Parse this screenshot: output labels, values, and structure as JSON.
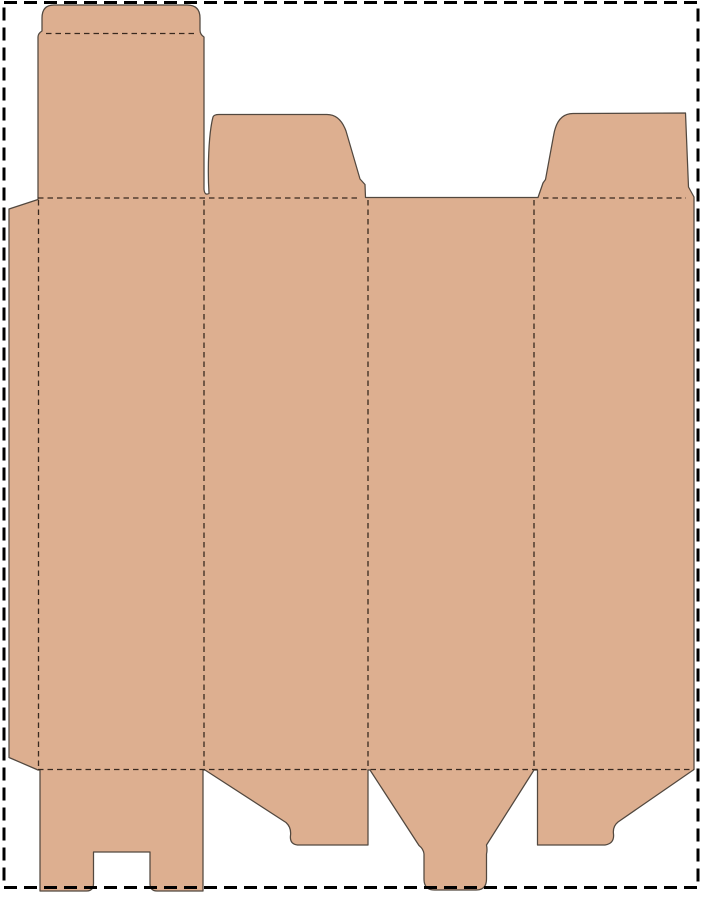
{
  "diagram": {
    "type": "packaging-dieline",
    "description": "Die-cut folding carton template (dieline): four body panels with glue flap, tuck-top lid, two top dust flaps, and bottom closure flaps, inside a dashed cutting-mat border",
    "canvas": {
      "width": 701,
      "height": 900
    },
    "colors": {
      "background": "#ffffff",
      "board_fill": "#DDAF90",
      "cut_line": "#52483f",
      "fold_line": "#39291f",
      "sheet_border": "#000000"
    },
    "sheet_border": {
      "x": 4,
      "y": 2.5,
      "width": 694,
      "height": 885,
      "stroke_width": 3,
      "dash": "13 7"
    },
    "blank": {
      "outline_path": "M 54 5 L 187 5 Q 200 5 200 18 L 200 30 Q 200 34.5 204 37 L 204 189 Q 204.5 196 209 193.5 C 207.5 170 208.5 134 213 117 Q 214 114.5 219 114.5 L 327 114.5 Q 340 114.5 346 131 L 360 179 L 365 184.5 L 365.5 197.5 L 538 197.5 L 543 183 L 545.5 179.5 L 553.5 136 Q 557 113.5 573 113.5 L 685.5 113 L 688.5 187 L 694 197 L 694 769.5 L 618 822 Q 612.5 826.5 613.5 834 Q 614.5 843.5 605 845 L 537.5 845 L 537.5 770 L 534 770 L 486.5 845 Q 487.5 850 486.5 854 L 486.5 879 Q 486.5 890 476 890 L 434.5 890 Q 424 890 424 879 L 424 854 Q 423.5 849 419 845.5 L 370 770 L 368 770 L 368 845 L 297.5 845 Q 289.5 844 290.5 835.5 Q 291.5 827.5 286 822.5 L 205 770 L 203 770 L 203 891 L 157 891 Q 150 891 150 883.5 L 150 852 L 93.5 852 L 93.5 883.5 Q 93.5 891 86.5 891 L 40 891 L 40 770 L 38 770 L 9 757.5 L 9 209 L 38 199.5 L 38 37 Q 38 33.5 42 31 L 42 18 Q 42 5 54 5 Z",
      "cut_stroke_width": 1.25
    },
    "fold_lines": [
      {
        "name": "tuck-flap-fold",
        "x1": 46,
        "y1": 33.5,
        "x2": 196,
        "y2": 33.5
      },
      {
        "name": "top-fold-left",
        "x1": 38,
        "y1": 198,
        "x2": 360,
        "y2": 198
      },
      {
        "name": "top-fold-right",
        "x1": 543,
        "y1": 198,
        "x2": 686,
        "y2": 198
      },
      {
        "name": "bottom-fold",
        "x1": 38,
        "y1": 769.5,
        "x2": 694,
        "y2": 769.5
      },
      {
        "name": "glue-flap-fold",
        "x1": 38.5,
        "y1": 200,
        "x2": 38.5,
        "y2": 769
      },
      {
        "name": "panel-fold-1",
        "x1": 204,
        "y1": 200,
        "x2": 204,
        "y2": 769
      },
      {
        "name": "panel-fold-2",
        "x1": 368,
        "y1": 200,
        "x2": 368,
        "y2": 769
      },
      {
        "name": "panel-fold-3",
        "x1": 534,
        "y1": 200,
        "x2": 534,
        "y2": 769
      }
    ],
    "fold_stroke_width": 1.3,
    "fold_dash": "5.5 4"
  }
}
